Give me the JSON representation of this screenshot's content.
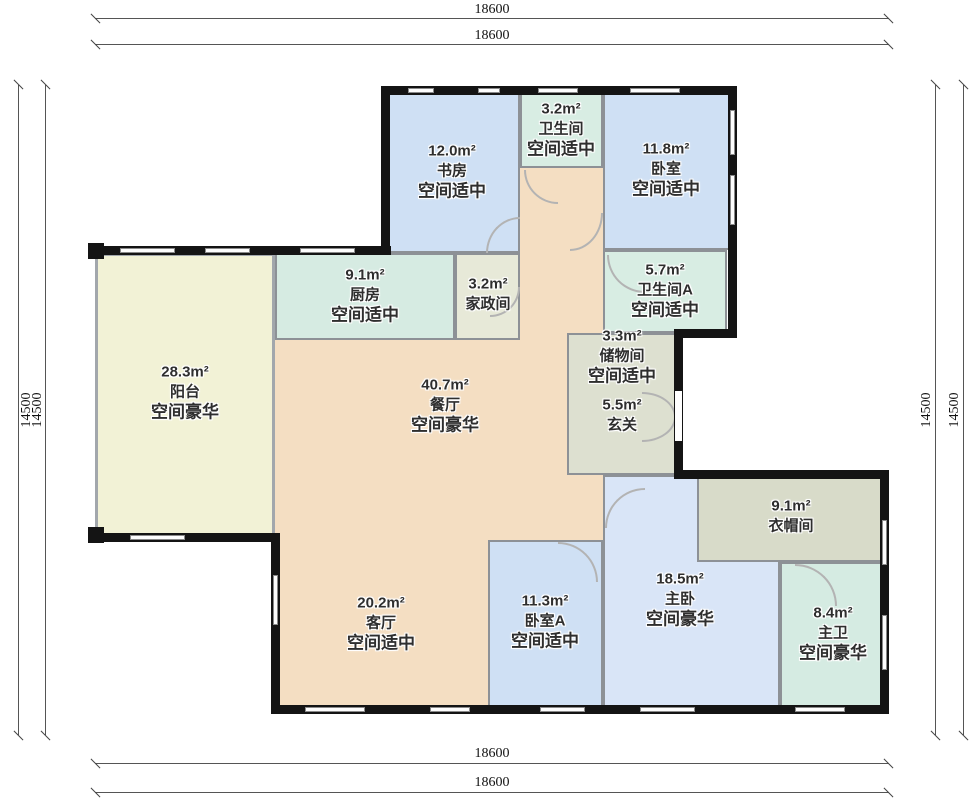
{
  "dimensions": {
    "top1": "18600",
    "top2": "18600",
    "bottom1": "18600",
    "bottom2": "18600",
    "left1": "14500",
    "left2": "14500",
    "right1": "14500",
    "right2": "14500"
  },
  "rooms": [
    {
      "area": "12.0m²",
      "name": "书房",
      "grade": "空间适中",
      "color": "#cfe0f4"
    },
    {
      "area": "3.2m²",
      "name": "卫生间",
      "grade": "空间适中",
      "color": "#d8ede3"
    },
    {
      "area": "11.8m²",
      "name": "卧室",
      "grade": "空间适中",
      "color": "#cfe0f4"
    },
    {
      "area": "9.1m²",
      "name": "厨房",
      "grade": "空间适中",
      "color": "#d6ebe2"
    },
    {
      "area": "3.2m²",
      "name": "家政间",
      "grade": "",
      "color": "#e7e9d8"
    },
    {
      "area": "5.7m²",
      "name": "卫生间A",
      "grade": "空间适中",
      "color": "#d8ede3"
    },
    {
      "area": "3.3m²",
      "name": "储物间",
      "grade": "空间适中",
      "color": "#dde0d0"
    },
    {
      "area": "5.5m²",
      "name": "玄关",
      "grade": "",
      "color": "#dde0d0"
    },
    {
      "area": "28.3m²",
      "name": "阳台",
      "grade": "空间豪华",
      "color": "#f2f2d6"
    },
    {
      "area": "40.7m²",
      "name": "餐厅",
      "grade": "空间豪华",
      "color": "#f4dec2"
    },
    {
      "area": "20.2m²",
      "name": "客厅",
      "grade": "空间适中",
      "color": "#f4dec2"
    },
    {
      "area": "11.3m²",
      "name": "卧室A",
      "grade": "空间适中",
      "color": "#cfe0f4"
    },
    {
      "area": "18.5m²",
      "name": "主卧",
      "grade": "空间豪华",
      "color": "#d9e5f7"
    },
    {
      "area": "9.1m²",
      "name": "衣帽间",
      "grade": "",
      "color": "#d8dbc9"
    },
    {
      "area": "8.4m²",
      "name": "主卫",
      "grade": "空间豪华",
      "color": "#d5ebe2"
    }
  ],
  "wall_colors": {
    "outer": "#141414",
    "inner": "#8d9196"
  }
}
